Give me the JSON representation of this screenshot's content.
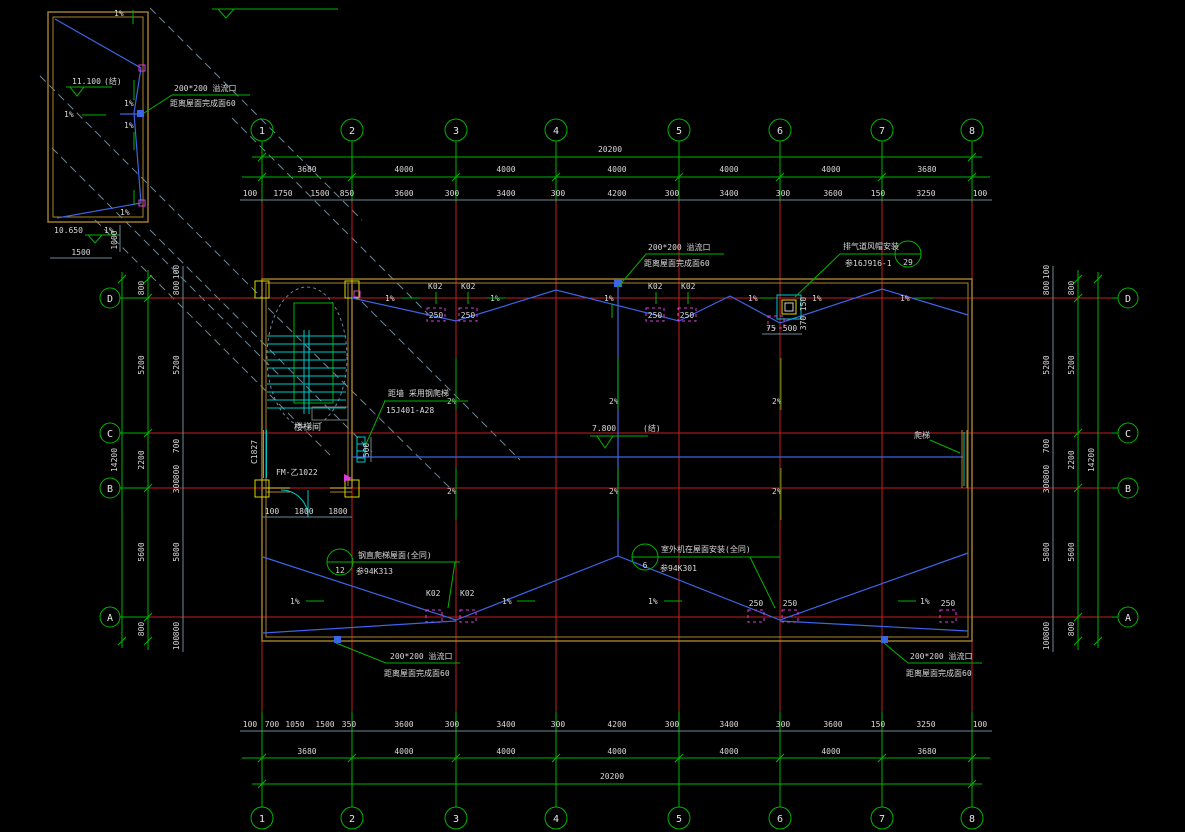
{
  "axes": {
    "cols": [
      "1",
      "2",
      "3",
      "4",
      "5",
      "6",
      "7",
      "8"
    ],
    "rows": [
      "D",
      "C",
      "B",
      "A"
    ]
  },
  "dims": {
    "top_overall": "20200",
    "bottom_overall": "20200",
    "spans": [
      "3680",
      "4000",
      "4000",
      "4000",
      "4000",
      "4000",
      "3680"
    ],
    "top_subs": [
      "100",
      "1750",
      "1500",
      "850",
      "3600",
      "300",
      "3400",
      "300",
      "4200",
      "300",
      "3400",
      "300",
      "3600",
      "150",
      "3250",
      "100"
    ],
    "bottom_subs": [
      "100",
      "700",
      "1050",
      "1500",
      "350",
      "3600",
      "300",
      "3400",
      "300",
      "4200",
      "300",
      "3400",
      "300",
      "3600",
      "150",
      "3250",
      "100"
    ],
    "side_overall": "14200",
    "side_spans": [
      "800",
      "5200",
      "2200",
      "5600",
      "800"
    ],
    "side_subs": [
      "100",
      "800",
      "5200",
      "700",
      "800",
      "300",
      "5800",
      "800",
      "100"
    ],
    "stair_subs": [
      "100",
      "1800",
      "1800"
    ],
    "ladder_height": "500",
    "inset_w": "1500",
    "inset_h": "1000",
    "vent": [
      "75",
      "500",
      "150",
      "370"
    ]
  },
  "labels": {
    "overflow_title": "200*200  溢流口",
    "overflow_sub": "距离屋面完成面60",
    "vent1": "排气道风帽安装",
    "vent2": "参16J916-1",
    "vent_no": "29",
    "ladder1": "距墙 采用钢爬梯",
    "ladder2": "15J401-A28",
    "b12_no": "12",
    "b12_1": "钢直爬梯屋面(全同)",
    "b12_2": "参94K313",
    "b6_no": "6",
    "b6_1": "室外机在屋面安装(全同)",
    "b6_2": "参94K301",
    "pati": "爬梯",
    "stairwell": "楼梯间",
    "window": "C1827",
    "door": "FM-乙1022",
    "k02": "K02",
    "d250": "250",
    "s1": "1%",
    "s2": "2%",
    "elev_main": "7.800",
    "jie": "(结)",
    "elev_top": "11.100",
    "elev_low": "10.650"
  },
  "colors": {
    "grid": "#c81e1e",
    "dims": "#00b400",
    "walls": "#a8842c",
    "drainage": "#3c64e6",
    "stair": "#00c8c8",
    "background": "#000000"
  }
}
